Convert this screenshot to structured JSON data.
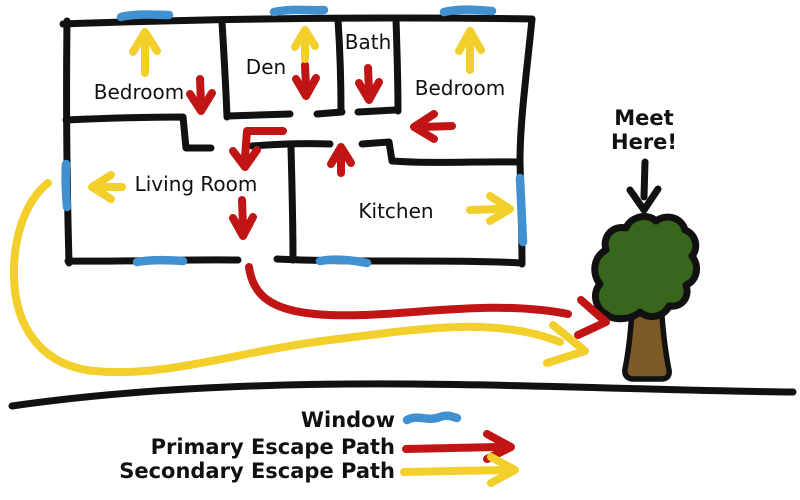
{
  "diagram": {
    "kind": "hand-drawn home fire escape plan"
  },
  "rooms": [
    {
      "id": "bedroom-left",
      "label": "Bedroom"
    },
    {
      "id": "den",
      "label": "Den"
    },
    {
      "id": "bath",
      "label": "Bath"
    },
    {
      "id": "bedroom-right",
      "label": "Bedroom"
    },
    {
      "id": "living-room",
      "label": "Living Room"
    },
    {
      "id": "kitchen",
      "label": "Kitchen"
    }
  ],
  "meeting_point": {
    "lines": [
      "Meet",
      "Here!"
    ],
    "marker": "tree-icon"
  },
  "legend": {
    "items": [
      {
        "label": "Window",
        "type": "window"
      },
      {
        "label": "Primary Escape Path",
        "type": "primary"
      },
      {
        "label": "Secondary Escape Path",
        "type": "secondary"
      }
    ]
  },
  "colors": {
    "wall": "#111111",
    "window": "#4191d0",
    "primary_path": "#c11414",
    "secondary_path": "#f3cf2b",
    "tree_foliage": "#39661d",
    "tree_trunk": "#7c5b28"
  }
}
